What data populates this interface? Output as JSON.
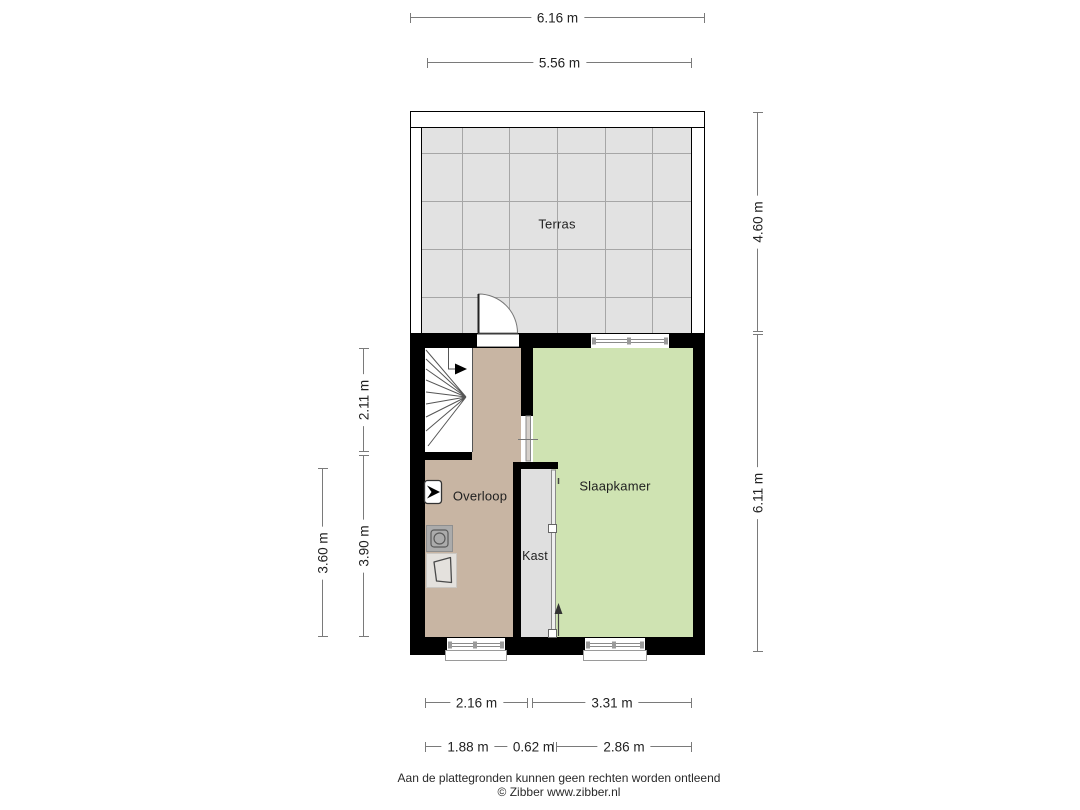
{
  "rooms": {
    "terras": "Terras",
    "overloop": "Overloop",
    "slaapkamer": "Slaapkamer",
    "kast": "Kast"
  },
  "dimensions": {
    "top_outer": "6.16 m",
    "top_inner": "5.56 m",
    "right_upper": "4.60 m",
    "right_lower": "6.11 m",
    "left_stairs": "2.11 m",
    "left_lower_inner": "3.90 m",
    "left_lower_outer": "3.60 m",
    "bottom_overloop": "2.16 m",
    "bottom_slaapkamer": "3.31 m",
    "bottom_detail_1": "1.88 m",
    "bottom_detail_2": "0.62 m",
    "bottom_detail_3": "2.86 m"
  },
  "icons": {
    "ventilation": "mechanical-ventilation-icon",
    "washer": "washing-machine-icon",
    "boiler": "boiler-icon",
    "stairs": "winder-stairs",
    "terrace_door": "door-swing",
    "interior_door": "door-leaf",
    "closet_door": "sliding-door"
  },
  "footer": {
    "line1": "Aan de plattegronden kunnen geen rechten worden ontleend",
    "line2": "© Zibber www.zibber.nl"
  },
  "colors": {
    "wall": "#000000",
    "terras-floor": "#e2e2e2",
    "terras-grid": "#a6a6a6",
    "overloop-floor": "#c8b5a3",
    "slaapkamer-floor": "#cfe3b2",
    "kast-floor": "#dfdfdf",
    "dim-line": "#7a7a7a",
    "text": "#1f1f1f"
  }
}
